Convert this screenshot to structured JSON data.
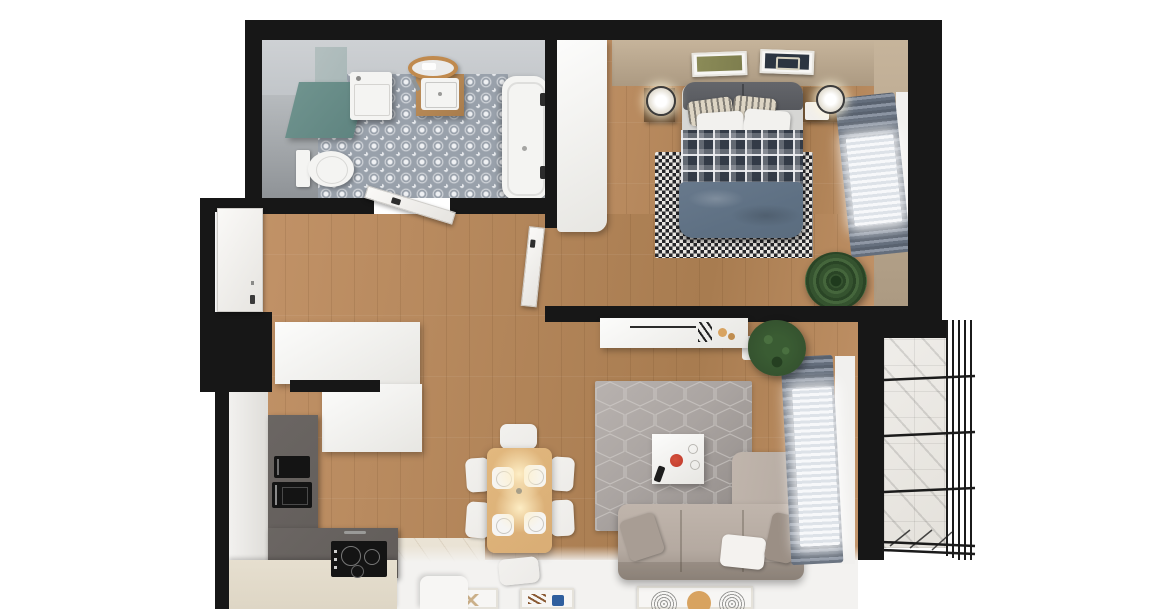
{
  "meta": {
    "title": "Top-down 3D render of a one-bedroom apartment floor plan with balcony",
    "view": "top-down cutaway",
    "canvas_width": 1169,
    "canvas_height": 609
  },
  "palette": {
    "white": "#ffffff",
    "wall": "#171717",
    "wood": "#c19267",
    "woodDark": "#a87c50",
    "tile": "#99a1ab",
    "tileLight": "#eef0f3",
    "shower": "#a4a8ac",
    "teal": "#5f8480",
    "tealTop": "#a9b8b8",
    "fixture": "#f4f4f2",
    "headboard": "#56585d",
    "plaid": "#333b47",
    "blanket": "#5e7083",
    "checkDark": "#26262a",
    "checkLight": "#ebe8e3",
    "tan": "#c6b49b",
    "tanDark": "#ac9a82",
    "drape": "#646e7c",
    "drapeLight": "#8b94a2",
    "sheer": "#f7f8fa",
    "hexRug": "#aaa4a1",
    "hexRugDark": "#8f8986",
    "hexLine": "#d6d2cf",
    "sofa": "#b5aaa1",
    "sofaDark": "#9a9087",
    "pillowGray": "#a89d94",
    "counter": "#615c59",
    "counterFront": "#ded6c5",
    "kitchenFloor": "#eae3d5",
    "appliance": "#141414",
    "tableWood": "#d9ad75",
    "chair": "#edebe8",
    "glow": "#ffe9b8",
    "balcony": "#e4e1db",
    "railing": "#1b1b1b",
    "plant": "#35532f",
    "plantDark": "#1f3a1d",
    "red": "#bf3a2b",
    "orange": "#d8a360",
    "blue": "#2f5f9e",
    "artOlive": "#7e7e4e",
    "artNavy": "#2c3541",
    "frame": "#f7f6f4"
  },
  "rooms": [
    {
      "id": "bathroom",
      "furniture": [
        "patterned-tile-floor",
        "shower-zone",
        "storage-cabinet",
        "washing-machine",
        "round-wood-mirror",
        "sink-vanity",
        "toilet",
        "bathtub",
        "wall-faucets"
      ]
    },
    {
      "id": "bedroom",
      "furniture": [
        "white-wardrobe",
        "double-bed",
        "headboard",
        "printed-text-pillows",
        "plaid-duvet",
        "blue-blanket",
        "checkered-rug",
        "nightstand-left",
        "nightstand-right",
        "sphere-lamps",
        "wall-art-left",
        "wall-art-right",
        "window-drapes",
        "sheer-curtain",
        "potted-plant"
      ]
    },
    {
      "id": "hallway",
      "furniture": [
        "entrance-door",
        "hall-wardrobe",
        "open-bathroom-door",
        "bedroom-door"
      ]
    },
    {
      "id": "kitchen",
      "furniture": [
        "l-shaped-dark-counter",
        "built-in-oven",
        "microwave",
        "induction-cooktop",
        "sink-faucet",
        "upper-cabinet",
        "cream-front-counter",
        "white-stool"
      ]
    },
    {
      "id": "living-dining",
      "furniture": [
        "dining-table",
        "dining-chairs",
        "place-settings",
        "pendant-light-glow",
        "hexagon-rug",
        "coffee-table",
        "red-bowl",
        "remote-control",
        "corner-sofa",
        "sofa-cushions",
        "tv-console",
        "decor-objects",
        "potted-plant",
        "window-drapes",
        "sheer-curtain",
        "floor-posters"
      ]
    },
    {
      "id": "balcony",
      "furniture": [
        "tile-floor",
        "metal-railing"
      ]
    }
  ]
}
